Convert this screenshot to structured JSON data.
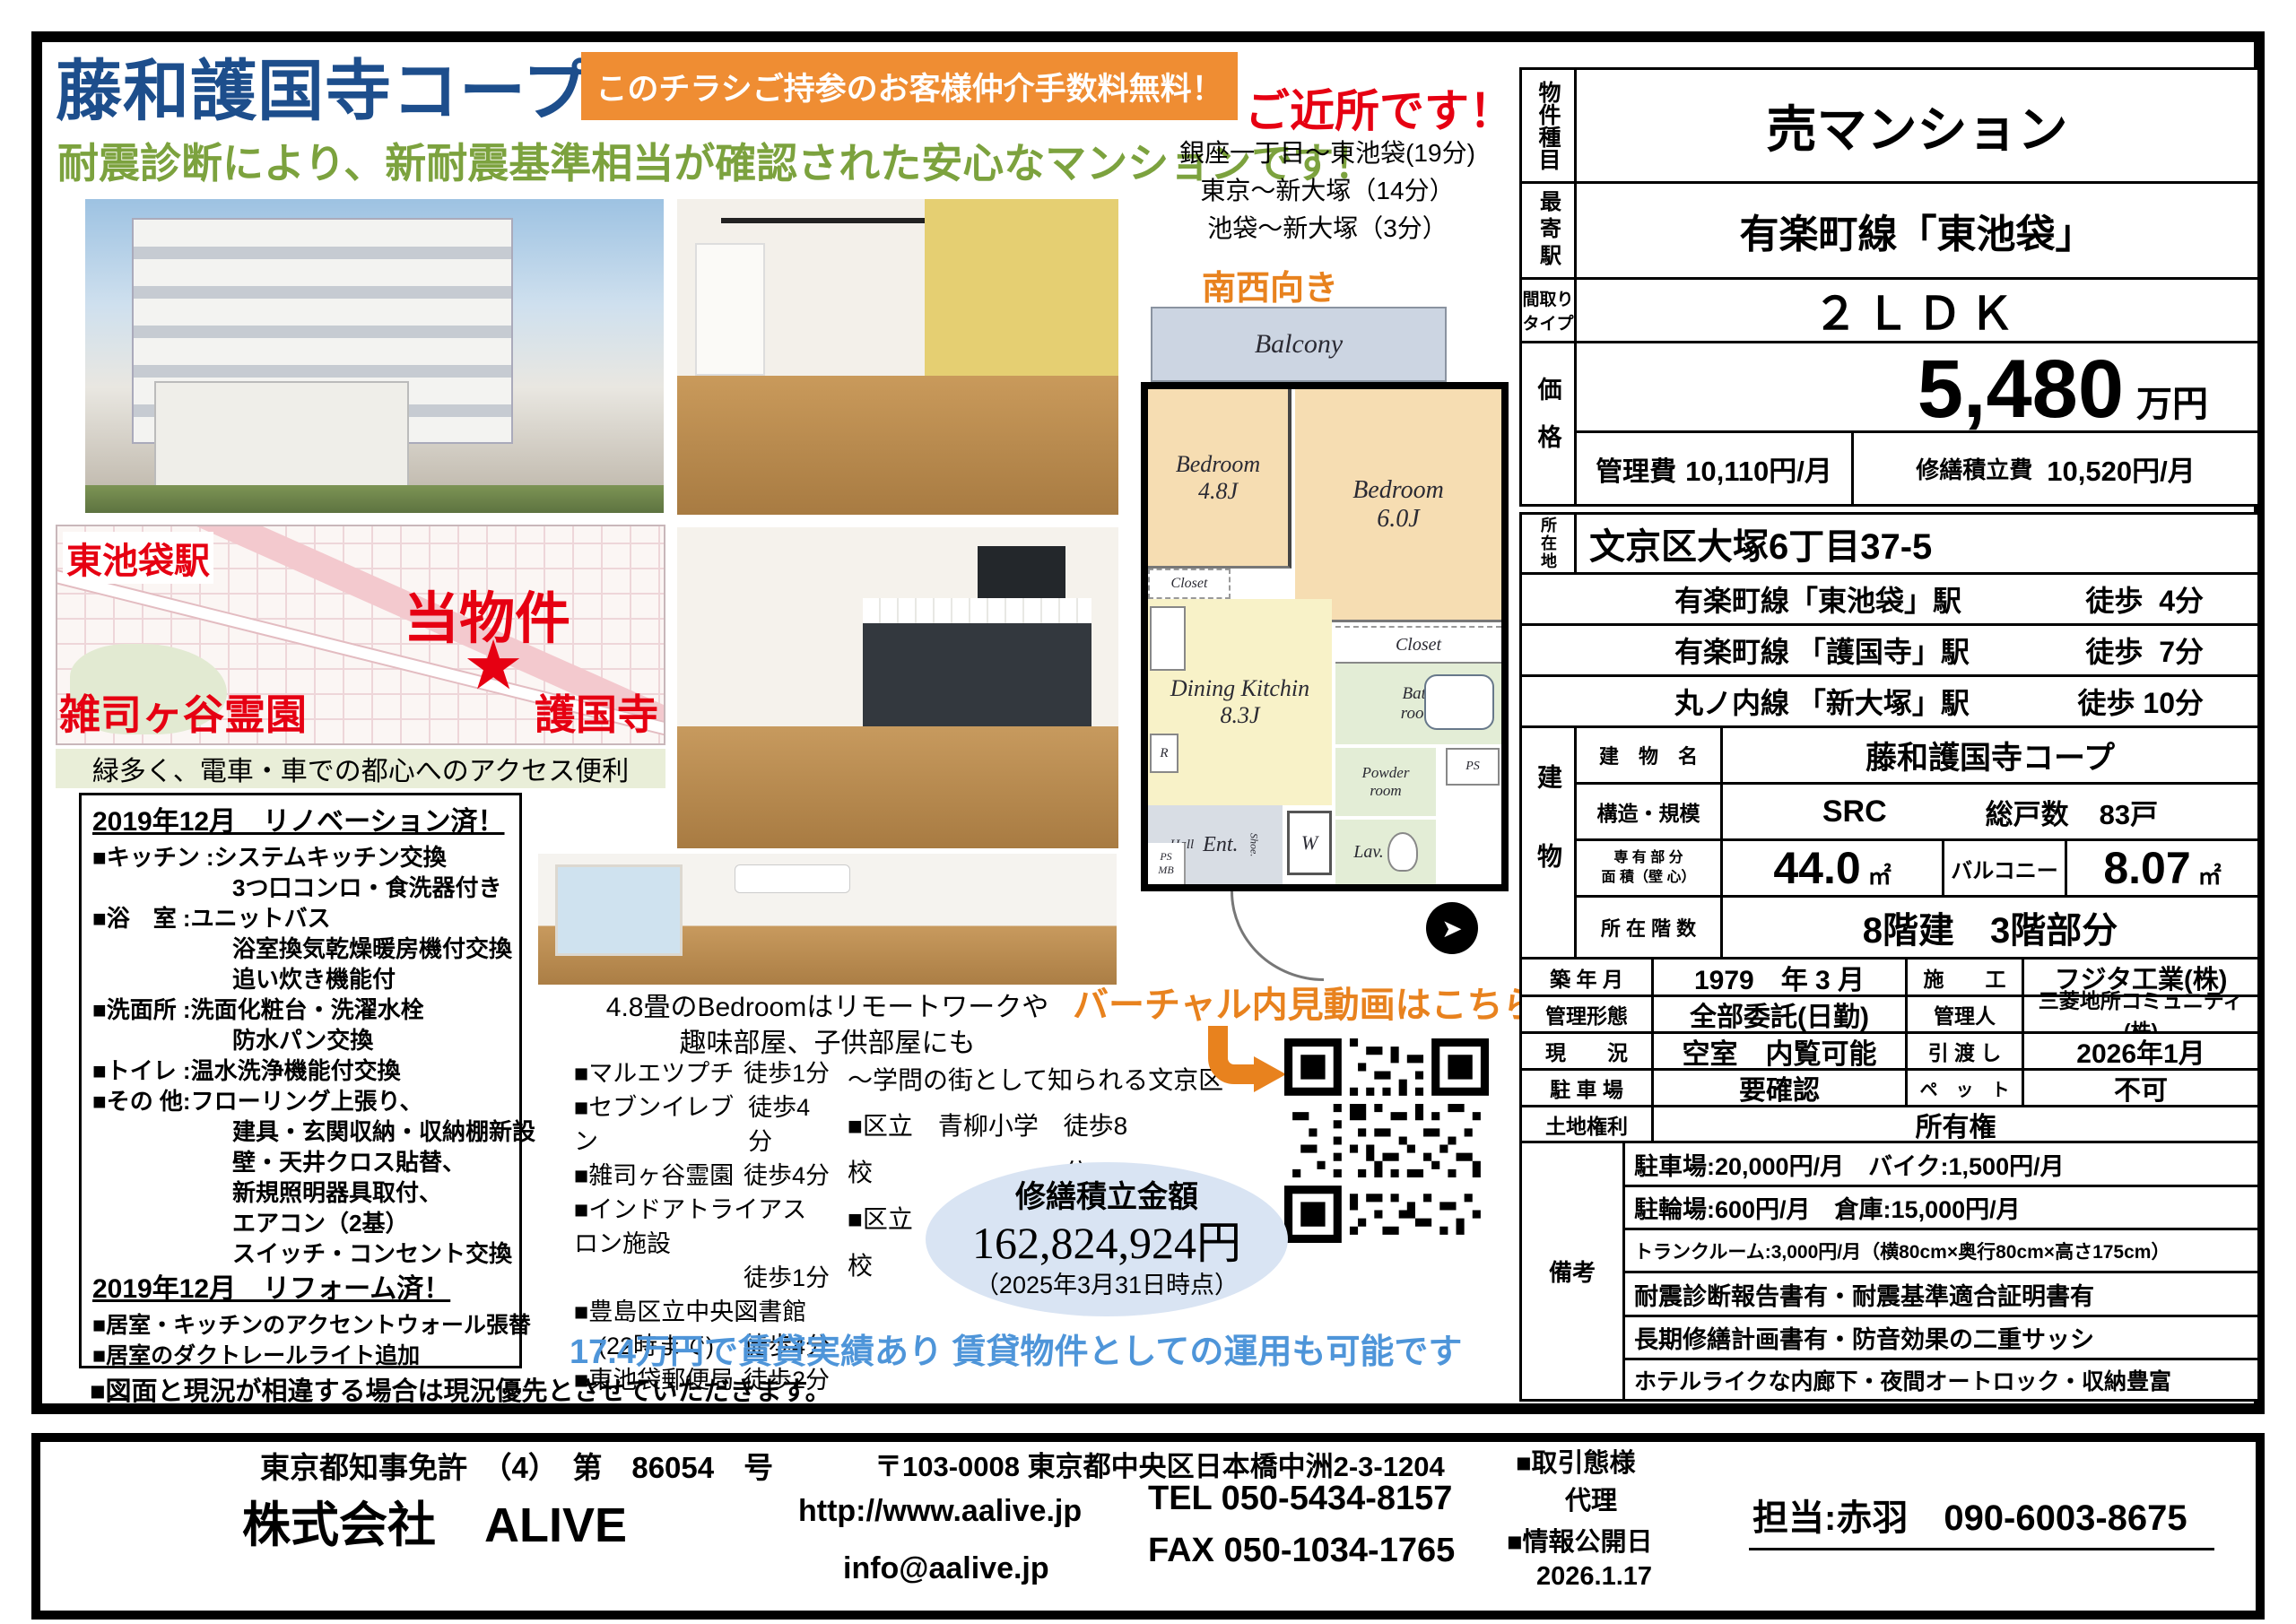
{
  "header": {
    "title": "藤和護国寺コープ",
    "banner": "このチラシご持参のお客様仲介手数料無料！",
    "subtitle": "耐震診断により、新耐震基準相当が確認された安心なマンションです！"
  },
  "nearby": {
    "heading": "ご近所です！",
    "line1": "銀座一丁目～東池袋(19分)",
    "line2": "東京～新大塚（14分）",
    "line3": "池袋～新大塚（3分）"
  },
  "map": {
    "station": "東池袋駅",
    "property": "当物件",
    "star": "★",
    "cemetery": "雑司ヶ谷霊園",
    "temple": "護国寺",
    "caption": "緑多く、電車・車での都心へのアクセス便利"
  },
  "floorplan": {
    "direction": "南西向き",
    "balcony": "Balcony",
    "bedroom1_name": "Bedroom",
    "bedroom1_size": "4.8J",
    "bedroom2_name": "Bedroom",
    "bedroom2_size": "6.0J",
    "dk_name": "Dining Kitchin",
    "dk_size": "8.3J",
    "closet1": "Closet",
    "closet2": "Closet",
    "bath1": "Bath",
    "bath2": "room",
    "powder1": "Powder",
    "powder2": "room",
    "lav": "Lav.",
    "hall": "Hall",
    "ent": "Ent.",
    "shoe": "Shoe.",
    "w": "W",
    "r": "R",
    "ps": "PS",
    "ps_mb": "PS MB",
    "arrow": "➤"
  },
  "photos": {
    "caption1": "4.8畳のBedroomはリモートワークや",
    "caption2": "趣味部屋、子供部屋にも"
  },
  "amenities": [
    {
      "n": "■マルエツプチ",
      "w": "徒歩1分"
    },
    {
      "n": "■セブンイレブン",
      "w": "徒歩4分"
    },
    {
      "n": "■雑司ヶ谷霊園",
      "w": "徒歩4分"
    },
    {
      "n": "■インドアトライアスロン施設",
      "w": ""
    },
    {
      "n": "",
      "w": "徒歩1分"
    },
    {
      "n": "■豊島区立中央図書館",
      "w": ""
    },
    {
      "n": "　(22時まで)",
      "w": "徒歩4分"
    },
    {
      "n": "■東池袋郵便局",
      "w": "徒歩2分"
    }
  ],
  "schools": {
    "heading": "～学問の街として知られる文京区～",
    "s1n": "■区立　青柳小学校",
    "s1w": "徒歩8分",
    "s2n": "■区立　音羽中学校",
    "s2w": "徒歩18分"
  },
  "virtual_tour": {
    "label": "バーチャル内見動画はこちら"
  },
  "repair_fund": {
    "title": "修繕積立金額",
    "amount": "162,824,924円",
    "as_of": "（2025年3月31日時点）"
  },
  "rental_note": "17.4万円で賃貸実績あり 賃貸物件としての運用も可能です",
  "renovation": {
    "title1": "2019年12月　リノベーション済！",
    "lines1": [
      "■キッチン :システムキッチン交換",
      "　　　　　　3つ口コンロ・食洗器付き",
      "■浴　室 :ユニットバス",
      "　　　　　　浴室換気乾燥暖房機付交換",
      "　　　　　　追い炊き機能付",
      "■洗面所 :洗面化粧台・洗濯水栓",
      "　　　　　　防水パン交換",
      "■トイレ :温水洗浄機能付交換",
      "■その 他:フローリング上張り、",
      "　　　　　　建具・玄関収納・収納棚新設",
      "　　　　　　壁・天井クロス貼替、",
      "　　　　　　新規照明器具取付、",
      "　　　　　　エアコン（2基）",
      "　　　　　　スイッチ・コンセント交換"
    ],
    "title2": "2019年12月　リフォーム済！",
    "lines2": [
      "■居室・キッチンのアクセントウォール張替",
      "■居室のダクトレールライト追加"
    ]
  },
  "disclaimer": "■図面と現況が相違する場合は現況優先とさせていただきます。",
  "spec": {
    "type_label": "物件種目",
    "type": "売マンション",
    "station_label": "最寄駅",
    "station": "有楽町線「東池袋」",
    "layout_label1": "間取り",
    "layout_label2": "タイプ",
    "layout": "２ＬＤＫ",
    "price_label": "価格",
    "price": "5,480",
    "price_unit": "万円",
    "mgmt_fee_label": "管理費",
    "mgmt_fee": "10,110円/月",
    "repair_fee_label": "修繕積立費",
    "repair_fee": "10,520円/月",
    "addr_label": "所在地",
    "addr": "文京区大塚6丁目37-5",
    "stations": [
      {
        "n": "有楽町線「東池袋」駅",
        "w": "徒歩  4分"
      },
      {
        "n": "有楽町線 「護国寺」駅",
        "w": "徒歩  7分"
      },
      {
        "n": "丸ノ内線 「新大塚」駅",
        "w": "徒歩 10分"
      }
    ],
    "bldg_label": "建物",
    "name_label": "建　物　名",
    "name": "藤和護国寺コープ",
    "structure_label": "構造・規模",
    "structure": "SRC",
    "units_label": "総戸数",
    "units": "83戸",
    "area_label1": "専 有 部 分",
    "area_label2": "面 積（壁 心）",
    "area": "44.0",
    "area_unit": "㎡",
    "balcony_label": "バルコニー",
    "balcony_area": "8.07",
    "balcony_unit": "㎡",
    "floor_label": "所 在 階 数",
    "floor": "8階建　3階部分",
    "built_label": "築 年 月",
    "built": "1979　年 3 月",
    "builder_label": "施　　工",
    "builder": "フジタ工業(株)",
    "mgmt_label": "管理形態",
    "mgmt": "全部委託(日勤)",
    "manager_label": "管理人",
    "manager": "三菱地所コミュニティ(株)",
    "status_label": "現　　況",
    "status": "空室　内覧可能",
    "handover_label": "引 渡 し",
    "handover": "2026年1月",
    "parking_label": "駐 車 場",
    "parking": "要確認",
    "pet_label": "ペ　ッ　ト",
    "pet": "不可",
    "land_label": "土地権利",
    "land": "所有権",
    "remarks_label": "備考",
    "remarks": [
      "駐車場:20,000円/月　バイク:1,500円/月",
      "駐輪場:600円/月　倉庫:15,000円/月",
      "トランクルーム:3,000円/月（横80cm×奥行80cm×高さ175cm）",
      "耐震診断報告書有・耐震基準適合証明書有",
      "長期修繕計画書有・防音効果の二重サッシ",
      "ホテルライクな内廊下・夜間オートロック・収納豊富"
    ]
  },
  "footer": {
    "license": "東京都知事免許　（4）　第　86054　号",
    "company": "株式会社　ALIVE",
    "address": "〒103-0008 東京都中央区日本橋中洲2-3-1204",
    "url": "http://www.aalive.jp",
    "email": "info@aalive.jp",
    "tel": "TEL 050-5434-8157",
    "fax": "FAX 050-1034-1765",
    "deal_label": "■取引態様",
    "deal": "代理",
    "publish_label": "■情報公開日",
    "publish": "2026.1.17",
    "contact": "担当:赤羽　090-6003-8675"
  },
  "colors": {
    "title_blue": "#1d4e8c",
    "banner_orange": "#ef8d33",
    "subtitle_green": "#7ca23e",
    "accent_red": "#e60012",
    "note_blue": "#4e95d9"
  }
}
